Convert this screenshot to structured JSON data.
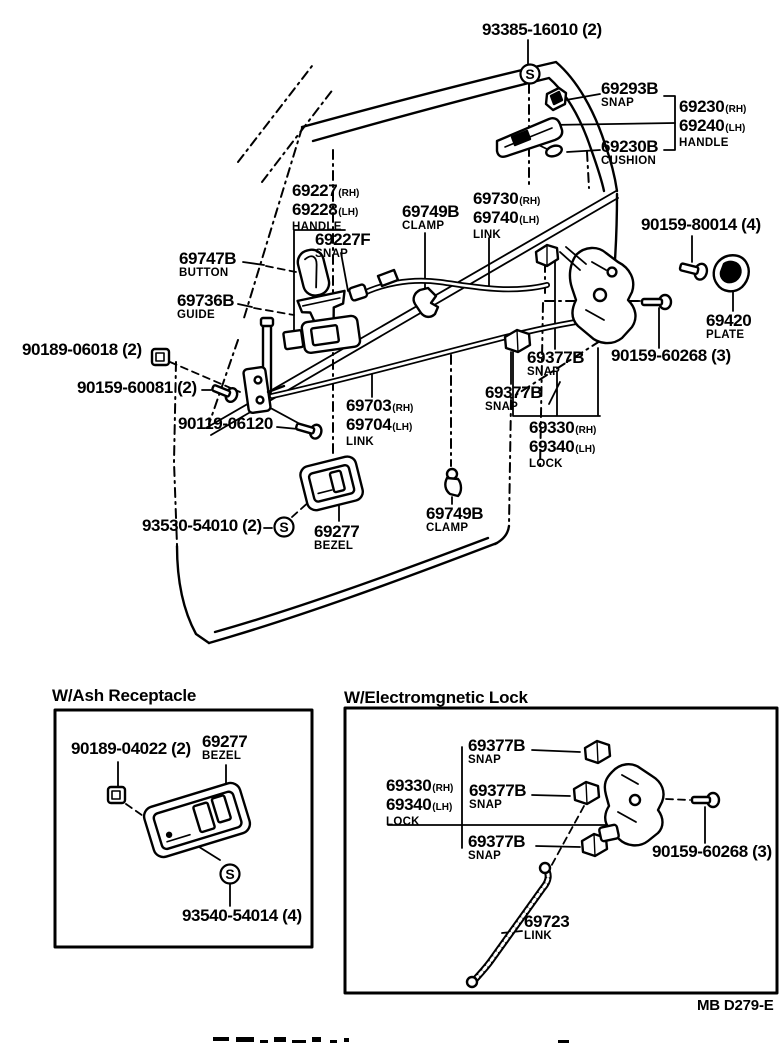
{
  "glyphs": {
    "screw_symbol": "S"
  },
  "main": {
    "c_93385": {
      "text": "93385-16010 (2)"
    },
    "c_69293b": {
      "no": "69293B",
      "name": "SNAP"
    },
    "c_outer_handle": {
      "no1": "69230",
      "s1": "(RH)",
      "no2": "69240",
      "s2": "(LH)",
      "name": "HANDLE"
    },
    "c_69230b": {
      "no": "69230B",
      "name": "CUSHION"
    },
    "c_inner_handle": {
      "no1": "69227",
      "s1": "(RH)",
      "no2": "69228",
      "s2": "(LH)",
      "name": "HANDLE"
    },
    "c_69227f": {
      "no": "69227F",
      "name": "SNAP"
    },
    "c_69749b_top": {
      "no": "69749B",
      "name": "CLAMP"
    },
    "c_link_upper": {
      "no1": "69730",
      "s1": "(RH)",
      "no2": "69740",
      "s2": "(LH)",
      "name": "LINK"
    },
    "c_90159_80014": {
      "text": "90159-80014 (4)"
    },
    "c_69747b": {
      "no": "69747B",
      "name": "BUTTON"
    },
    "c_69736b": {
      "no": "69736B",
      "name": "GUIDE"
    },
    "c_69420": {
      "no": "69420",
      "name": "PLATE"
    },
    "c_90189_06018": {
      "text": "90189-06018 (2)"
    },
    "c_69377b_1": {
      "no": "69377B",
      "name": "SNAP"
    },
    "c_90159_60268": {
      "text": "90159-60268 (3)"
    },
    "c_90159_60081": {
      "text": "90159-60081 (2)"
    },
    "c_69377b_2": {
      "no": "69377B",
      "name": "SNAP"
    },
    "c_90119_06120": {
      "text": "90119-06120"
    },
    "c_link_lower": {
      "no1": "69703",
      "s1": "(RH)",
      "no2": "69704",
      "s2": "(LH)",
      "name": "LINK"
    },
    "c_lock": {
      "no1": "69330",
      "s1": "(RH)",
      "no2": "69340",
      "s2": "(LH)",
      "name": "LOCK"
    },
    "c_69749b_bot": {
      "no": "69749B",
      "name": "CLAMP"
    },
    "c_93530": {
      "text": "93530-54010 (2)"
    },
    "c_69277": {
      "no": "69277",
      "name": "BEZEL"
    }
  },
  "inset_ash": {
    "title": "W/Ash Receptacle",
    "c_90189_04022": {
      "text": "90189-04022 (2)"
    },
    "c_69277": {
      "no": "69277",
      "name": "BEZEL"
    },
    "c_93540": {
      "text": "93540-54014 (4)"
    }
  },
  "inset_lock": {
    "title": "W/Electromgnetic Lock",
    "c_69377b_1": {
      "no": "69377B",
      "name": "SNAP"
    },
    "c_lock": {
      "no1": "69330",
      "s1": "(RH)",
      "no2": "69340",
      "s2": "(LH)",
      "name": "LOCK"
    },
    "c_69377b_2": {
      "no": "69377B",
      "name": "SNAP"
    },
    "c_69377b_3": {
      "no": "69377B",
      "name": "SNAP"
    },
    "c_90159_60268": {
      "text": "90159-60268 (3)"
    },
    "c_69723": {
      "no": "69723",
      "name": "LINK"
    }
  },
  "footer": {
    "code": "MB D279-E"
  }
}
